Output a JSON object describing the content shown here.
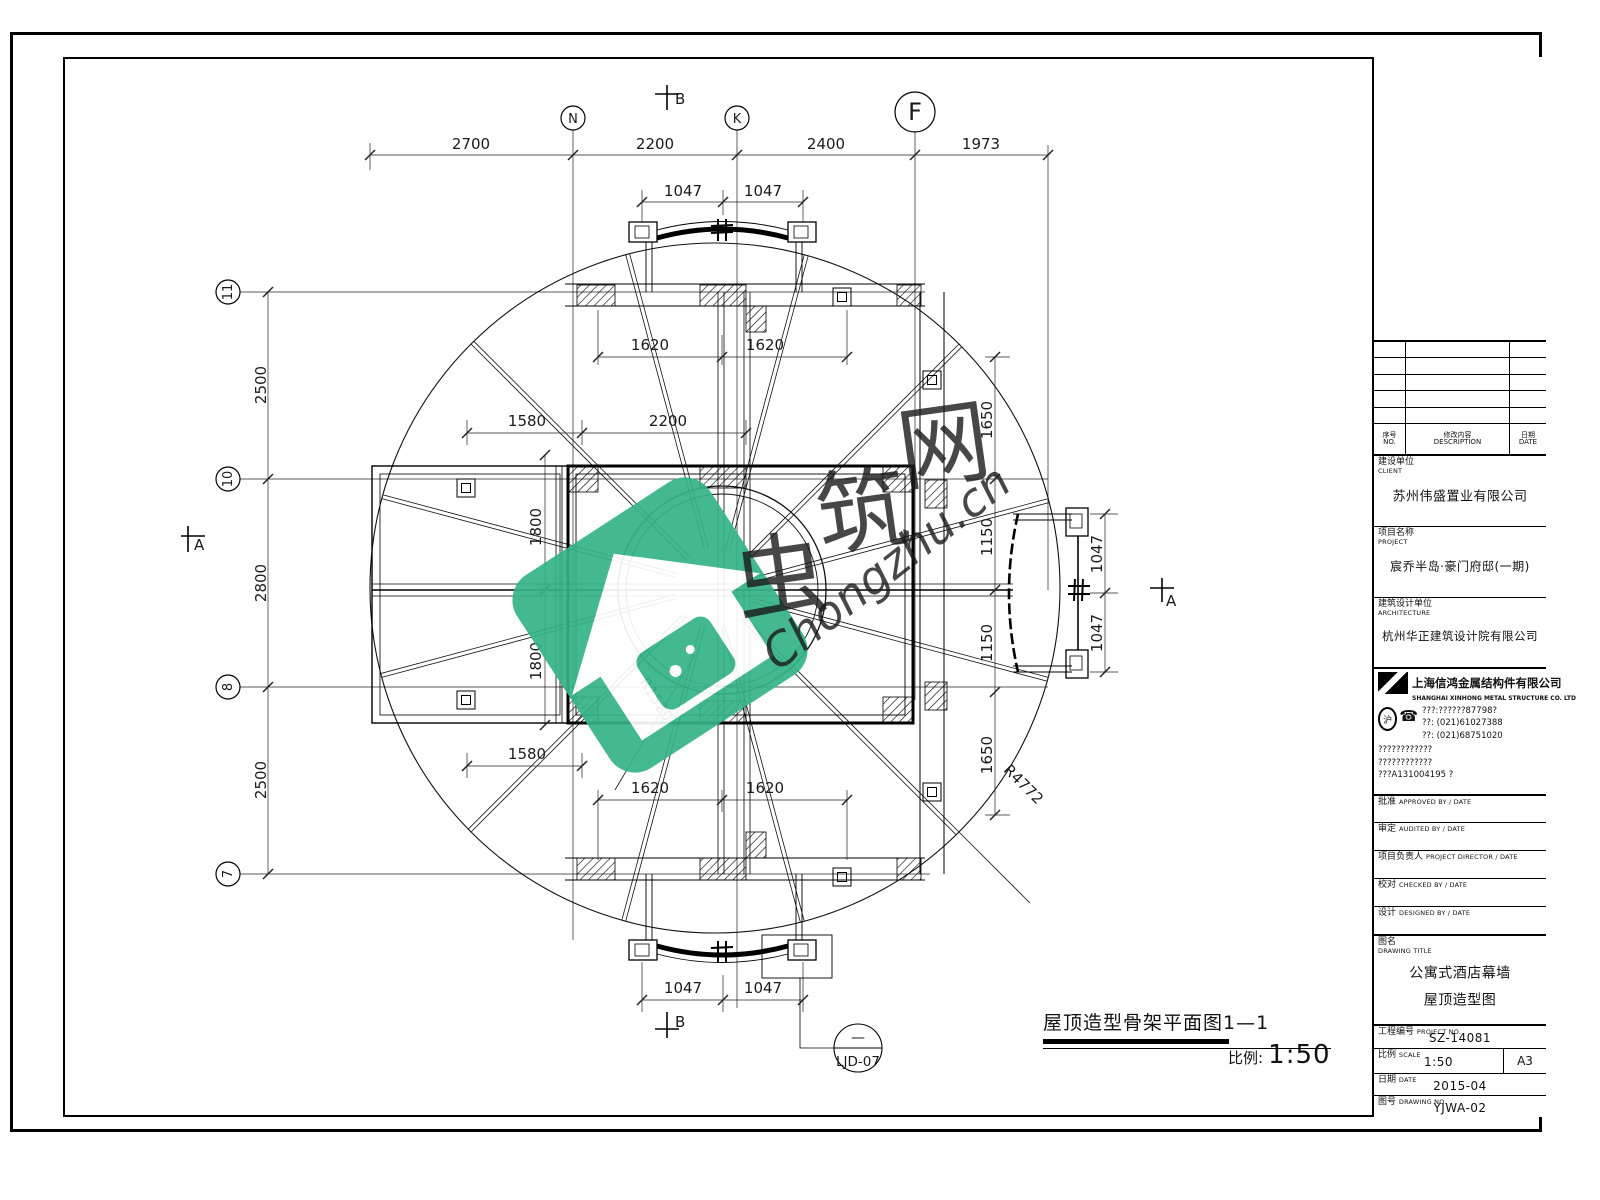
{
  "plan": {
    "grid": {
      "top": [
        "N",
        "K",
        "F"
      ],
      "left": [
        "11",
        "10",
        "8",
        "7"
      ]
    },
    "dims": {
      "top": [
        "2700",
        "2200",
        "2400",
        "1973"
      ],
      "top_inner": [
        "1047",
        "1047"
      ],
      "upper1620": [
        "1620",
        "1620"
      ],
      "mid": [
        "1580",
        "2200"
      ],
      "v1800": [
        "1800",
        "1800"
      ],
      "lower1580": "1580",
      "lower1620": [
        "1620",
        "1620"
      ],
      "bottom1047": [
        "1047",
        "1047"
      ],
      "left": [
        "2500",
        "2800",
        "2500"
      ],
      "right": [
        "1650",
        "1150",
        "1150",
        "1650"
      ],
      "right1047": [
        "1047",
        "1047"
      ]
    },
    "radius": {
      "outer": "R4772",
      "inner": "R1520"
    },
    "markers": {
      "a": "A",
      "b": "B"
    },
    "detail": {
      "dash": "—",
      "label": "LJD-07"
    },
    "title": {
      "text": "屋顶造型骨架平面图1—1",
      "scale_label": "比例:",
      "scale_value": "1:50"
    }
  },
  "watermark": {
    "chars": [
      "虫",
      "筑",
      "网"
    ],
    "script": "Chongzhu.cn",
    "green": "#35b487",
    "gray": "#9c9c9c"
  },
  "titleblock": {
    "revision": {
      "no_cn": "序号",
      "no_en": "NO.",
      "desc_cn": "修改内容",
      "desc_en": "DESCRIPTION",
      "date_cn": "日期",
      "date_en": "DATE"
    },
    "client": {
      "label": "建设单位",
      "label_en": "CLIENT",
      "value": "苏州伟盛置业有限公司"
    },
    "project": {
      "label": "项目名称",
      "label_en": "PROJECT",
      "value": "宸乔半岛·豪门府邸(一期)"
    },
    "architecture": {
      "label": "建筑设计单位",
      "label_en": "ARCHITECTURE",
      "value": "杭州华正建筑设计院有限公司"
    },
    "fabricator": {
      "name_cn": "上海信鸿金属结构件有限公司",
      "name_en": "SHANGHAI XINHONG METAL STRUCTURE CO. LTD",
      "seal_glyph": "沪",
      "phone_glyph": "☎",
      "tel0": "???:??????87798?",
      "tel": "??:  (021)61027388",
      "fax": "??:  (021)68751020",
      "addr1": "????????????",
      "addr2": "????????????",
      "cert": "???A131004195 ?"
    },
    "signatures": [
      {
        "label": "批准",
        "en": "APPROVED BY / DATE"
      },
      {
        "label": "审定",
        "en": "AUDITED BY / DATE"
      },
      {
        "label": "项目负责人",
        "en": "PROJECT DIRECTOR / DATE"
      },
      {
        "label": "校对",
        "en": "CHECKED BY / DATE"
      },
      {
        "label": "设计",
        "en": "DESIGNED BY / DATE"
      }
    ],
    "drawing_title": {
      "label": "图名",
      "label_en": "DRAWING TITLE",
      "line1": "公寓式酒店幕墙",
      "line2": "屋顶造型图"
    },
    "project_no": {
      "label": "工程编号",
      "label_en": "PROJECT NO.",
      "value": "SZ-14081"
    },
    "scale": {
      "label": "比例",
      "label_en": "SCALE",
      "value": "1:50",
      "size": "A3"
    },
    "date": {
      "label": "日期",
      "label_en": "DATE",
      "value": "2015-04"
    },
    "drawing_no": {
      "label": "图号",
      "label_en": "DRAWING NO.",
      "value": "YJWA-02"
    }
  }
}
